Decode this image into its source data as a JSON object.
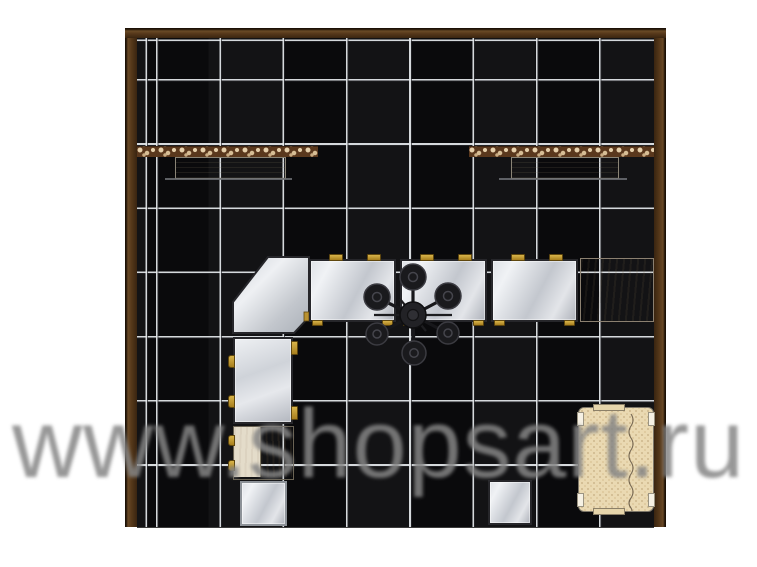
{
  "watermark": {
    "text": "www.shopsart.ru",
    "color": "#858585"
  },
  "room": {
    "wall_color": "#55381a",
    "floor_tile_color": "#0a0a0c",
    "grout_color": "#e6eaed",
    "tile_grid": "8 x 7 dark tiles"
  },
  "furniture": {
    "wall_displays": [
      {
        "name": "left ornamental frieze with shelf",
        "frieze_color": "#5a381d",
        "shelf_color": "#e9e2cd"
      },
      {
        "name": "right ornamental frieze with shelf",
        "frieze_color": "#5a381d",
        "shelf_color": "#e9e2cd"
      }
    ],
    "counter_run_top": [
      "corner glass showcase (angled)",
      "glass showcase",
      "glass showcase",
      "glass showcase",
      "wood counter"
    ],
    "counter_run_left": [
      "vertical glass showcase",
      "wood cabinet (two panels)",
      "small glass showcase"
    ],
    "freestanding": [
      "small glass showcase (bottom center)",
      "sofa (bottom right)"
    ],
    "ceiling": [
      "black chandelier, 6 round shades around central hub"
    ],
    "hardware_color": "#b9912f"
  },
  "palette": {
    "glass": "#ccd0d6",
    "wood_light": "#e0d5bc",
    "sofa": "#ead9b2",
    "watermark_gray": "#858585"
  }
}
